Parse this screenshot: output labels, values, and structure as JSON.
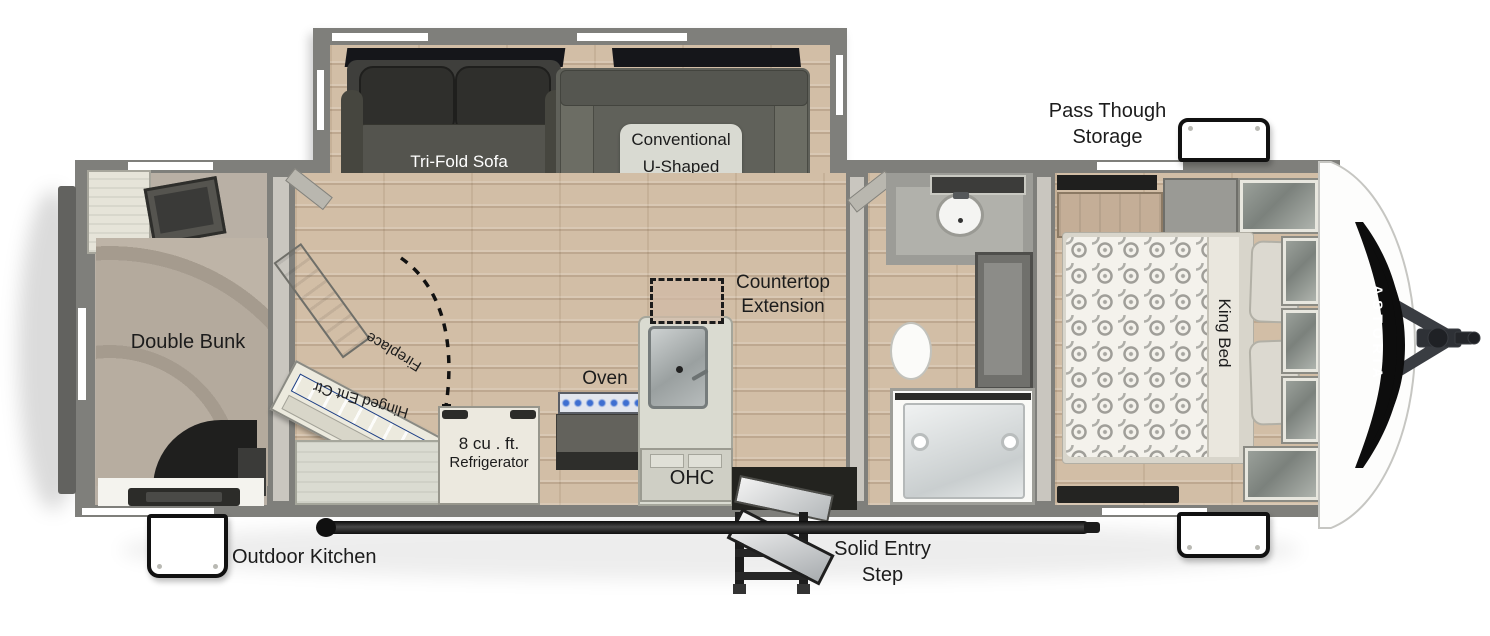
{
  "brand": "ASTORIA",
  "labels": {
    "tri_fold_sofa": "Tri-Fold Sofa",
    "dinette_lines": [
      "Conventional",
      "U-Shaped",
      "Dinette"
    ],
    "pass_through_lines": [
      "Pass Though",
      "Storage"
    ],
    "double_bunk": "Double Bunk",
    "fireplace": "Fireplace",
    "hinged_ent_ctr": "Hinged Ent Ctr",
    "refrigerator_lines": [
      "8 cu . ft.",
      "Refrigerator"
    ],
    "oven": "Oven",
    "ohc": "OHC",
    "countertop_lines": [
      "Countertop",
      "Extension"
    ],
    "king_bed": "King Bed",
    "outdoor_kitchen": "Outdoor Kitchen",
    "entry_step_lines": [
      "Solid Entry",
      "Step"
    ]
  },
  "colors": {
    "wall": "#7f7f7b",
    "floor_wood": "#d2bea6",
    "label_text": "#1c1c1c",
    "fireplace_accent": "#3f68c6",
    "decal": "#0d0d0d",
    "awning": "#1a1a1a",
    "sofa_dark": "#3f3f3c",
    "dinette_gray": "#60615a"
  }
}
